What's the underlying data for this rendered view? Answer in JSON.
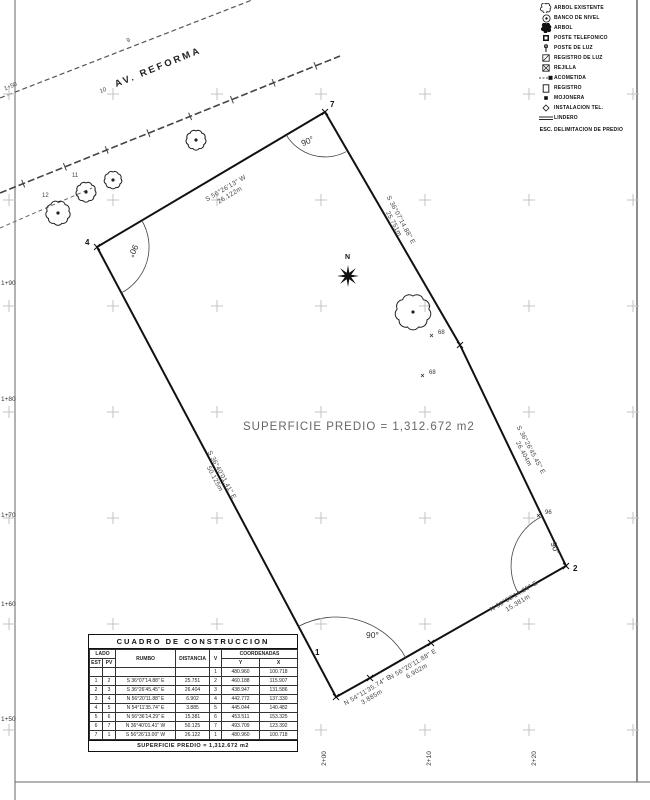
{
  "road": {
    "name": "AV. REFORMA",
    "tick_labels": [
      {
        "t": "1+50",
        "x": 4,
        "y": 84,
        "rot": -22
      },
      {
        "t": "10",
        "x": 100,
        "y": 88,
        "rot": -22
      },
      {
        "t": "9",
        "x": 127,
        "y": 38,
        "rot": -22
      },
      {
        "t": "12",
        "x": 42,
        "y": 193,
        "rot": 0
      },
      {
        "t": "11",
        "x": 72,
        "y": 173,
        "rot": 0
      }
    ]
  },
  "parcel": {
    "area_label": "SUPERFICIE PREDIO = 1,312.672 m2",
    "north_label": "N",
    "vertex_labels": [
      {
        "t": "7",
        "x": 330,
        "y": 100
      },
      {
        "t": "4",
        "x": 85,
        "y": 238
      },
      {
        "t": "2",
        "x": 573,
        "y": 564
      },
      {
        "t": "1",
        "x": 315,
        "y": 648
      }
    ],
    "angle_labels": [
      {
        "t": "90°",
        "x": 301,
        "y": 136,
        "rot": -25
      },
      {
        "t": "90°",
        "x": 127,
        "y": 246,
        "rot": 115
      },
      {
        "t": "90°",
        "x": 366,
        "y": 630,
        "rot": 0
      },
      {
        "t": "90°",
        "x": 549,
        "y": 543,
        "rot": 70
      }
    ],
    "edge_labels": [
      {
        "bearing": "S 56°26'13\" W",
        "dist": "26.122m",
        "x": 228,
        "y": 192,
        "rot": -30.6
      },
      {
        "bearing": "S 36°07'14.88\" E",
        "dist": "25.751m",
        "x": 397,
        "y": 222,
        "rot": 62
      },
      {
        "bearing": "S 36°26'45.45\" E",
        "dist": "26.404m",
        "x": 527,
        "y": 452,
        "rot": 62
      },
      {
        "bearing": "S 36°40'01.41\" E",
        "dist": "50.125m",
        "x": 218,
        "y": 477,
        "rot": 62
      },
      {
        "bearing": "N 56°36'14.29\" E",
        "dist": "15.381m",
        "x": 516,
        "y": 600,
        "rot": -30.6
      },
      {
        "bearing": "N 56°20'11.88\" E",
        "dist": "6.902m",
        "x": 415,
        "y": 668,
        "rot": -30.6
      },
      {
        "bearing": "N 54°11'35.74\" E",
        "dist": "3.885m",
        "x": 370,
        "y": 694,
        "rot": -30.6
      }
    ],
    "points": [
      {
        "t": "68",
        "x": 438,
        "y": 330
      },
      {
        "t": "68",
        "x": 429,
        "y": 370
      },
      {
        "t": "96",
        "x": 545,
        "y": 510
      }
    ]
  },
  "stations": {
    "left": [
      {
        "t": "1+90",
        "x": 1,
        "y": 280
      },
      {
        "t": "1+80",
        "x": 1,
        "y": 396
      },
      {
        "t": "1+70",
        "x": 1,
        "y": 512
      },
      {
        "t": "1+60",
        "x": 1,
        "y": 601
      },
      {
        "t": "1+50",
        "x": 1,
        "y": 716
      }
    ],
    "bottom": [
      {
        "t": "2+00",
        "x": 317,
        "y": 755
      },
      {
        "t": "2+10",
        "x": 422,
        "y": 755
      },
      {
        "t": "2+20",
        "x": 527,
        "y": 755
      }
    ]
  },
  "legend": {
    "items": [
      {
        "symbol": "tree-outline-icon",
        "label": "ARBOL EXISTENTE"
      },
      {
        "symbol": "benchmark-icon",
        "label": "BANCO DE NIVEL"
      },
      {
        "symbol": "tree-solid-icon",
        "label": "ARBOL"
      },
      {
        "symbol": "post-square-icon",
        "label": "POSTE TELEFONICO"
      },
      {
        "symbol": "light-post-icon",
        "label": "POSTE DE LUZ"
      },
      {
        "symbol": "register-box-icon",
        "label": "REGISTRO DE LUZ"
      },
      {
        "symbol": "box-x-icon",
        "label": "REJILLA"
      },
      {
        "symbol": "line-dot-icon",
        "label": "ACOMETIDA"
      },
      {
        "symbol": "rect-outline-icon",
        "label": "REGISTRO"
      },
      {
        "symbol": "dot-square-icon",
        "label": "MOJONERA"
      },
      {
        "symbol": "diamond-icon",
        "label": "INSTALACION TEL."
      },
      {
        "symbol": "double-line-icon",
        "label": "LINDERO"
      },
      {
        "symbol": "esc-icon",
        "label": "DELIMITACION DE PREDIO"
      }
    ],
    "esc_symbol_text": "ESC."
  },
  "table": {
    "title": "CUADRO DE CONSTRUCCION",
    "headers": {
      "lado": "LADO",
      "est": "EST",
      "pv": "PV",
      "rumbo": "RUMBO",
      "distancia": "DISTANCIA",
      "v": "V",
      "coordenadas": "COORDENADAS",
      "y": "Y",
      "x": "X"
    },
    "rows": [
      [
        "",
        "",
        "",
        "",
        "1",
        "480.960",
        "100.718"
      ],
      [
        "1",
        "2",
        "S 36°07'14.88\" E",
        "25.751",
        "2",
        "460.188",
        "115.907"
      ],
      [
        "2",
        "3",
        "S 36°26'45.45\" E",
        "26.404",
        "3",
        "438.947",
        "131.586"
      ],
      [
        "3",
        "4",
        "N 56°20'11.88\" E",
        "6.902",
        "4",
        "442.772",
        "137.330"
      ],
      [
        "4",
        "5",
        "N 54°11'35.74\" E",
        "3.885",
        "5",
        "445.044",
        "140.482"
      ],
      [
        "5",
        "6",
        "N 56°36'14.29\" E",
        "15.381",
        "6",
        "453.511",
        "153.325"
      ],
      [
        "6",
        "7",
        "N 36°40'01.41\" W",
        "50.125",
        "7",
        "493.709",
        "123.392"
      ],
      [
        "7",
        "1",
        "S 56°26'13.00\" W",
        "26.122",
        "1",
        "480.960",
        "100.718"
      ]
    ],
    "footer": "SUPERFICIE PREDIO = 1,312.672 m2"
  },
  "drawing": {
    "colors": {
      "line": "#111111",
      "grid_cross": "#c3c3c3",
      "frame": "#999999",
      "road": "#555555"
    },
    "grid_xs": [
      9,
      113,
      217,
      321,
      425,
      529,
      633
    ],
    "grid_ys": [
      94,
      200,
      306,
      412,
      518,
      624,
      730
    ],
    "polygon": [
      [
        325,
        112
      ],
      [
        460,
        345
      ],
      [
        566,
        566
      ],
      [
        431,
        643
      ],
      [
        370,
        678
      ],
      [
        336,
        697
      ],
      [
        97,
        247
      ]
    ],
    "trees_outline": [
      {
        "x": 58,
        "y": 213,
        "r": 11
      },
      {
        "x": 86,
        "y": 192,
        "r": 9
      },
      {
        "x": 113,
        "y": 180,
        "r": 8
      },
      {
        "x": 196,
        "y": 140,
        "r": 9
      },
      {
        "x": 413,
        "y": 312,
        "r": 16
      }
    ],
    "north": {
      "x": 348,
      "y": 276
    }
  }
}
